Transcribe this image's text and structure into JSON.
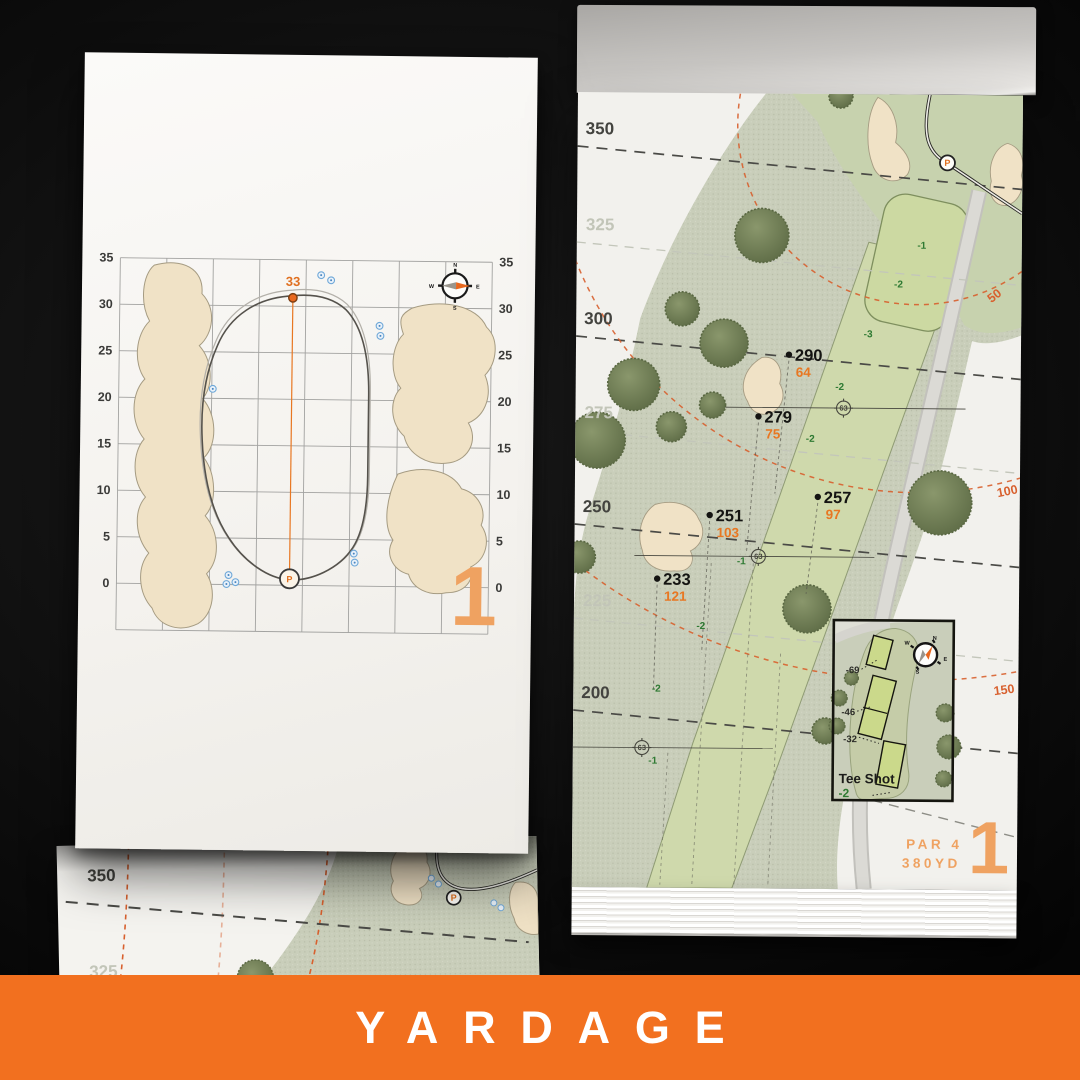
{
  "banner": {
    "label": "YARDAGE",
    "background": "#F2701F",
    "text_color": "#FFFFFF"
  },
  "colors": {
    "accent_orange": "#E87722",
    "page_number_orange": "#EFA261",
    "arc_orange": "#D8602E",
    "paper": "#F3F2EE",
    "rough_green": "#C9CEBA",
    "fairway_green": "#CFD9AC",
    "bunker_sand": "#F0E2C6",
    "tree_green": "#76845C",
    "elevation_green": "#2F7A33",
    "sprinkler_blue": "#6FA8D8"
  },
  "left_page": {
    "hole_number": "1",
    "front_distance": "33",
    "pin_symbol": "P",
    "axis_ticks": [
      "35",
      "30",
      "25",
      "20",
      "15",
      "10",
      "5",
      "0"
    ],
    "compass": {
      "n": "N",
      "e": "E",
      "s": "S",
      "w": "W"
    }
  },
  "right_page": {
    "hole_number": "1",
    "par": "PAR 4",
    "distance": "380YD",
    "pin_symbol": "P",
    "yardage_labels": [
      {
        "text": "350",
        "emphasis": "bold"
      },
      {
        "text": "325",
        "emphasis": "faint"
      },
      {
        "text": "300",
        "emphasis": "bold"
      },
      {
        "text": "275",
        "emphasis": "faint"
      },
      {
        "text": "250",
        "emphasis": "bold"
      },
      {
        "text": "225",
        "emphasis": "faint"
      },
      {
        "text": "200",
        "emphasis": "bold"
      }
    ],
    "arc_labels": [
      "50",
      "100",
      "150"
    ],
    "points": [
      {
        "carry": "290",
        "front": "64"
      },
      {
        "carry": "279",
        "front": "75"
      },
      {
        "carry": "257",
        "front": "97"
      },
      {
        "carry": "251",
        "front": "103"
      },
      {
        "carry": "233",
        "front": "121"
      }
    ],
    "sprinkler_numbers": [
      "63",
      "63",
      "63"
    ],
    "elevation_labels": [
      "-1",
      "-2",
      "-3",
      "-2",
      "-2",
      "-1",
      "-2",
      "-2",
      "-1"
    ],
    "tee_inset": {
      "title": "Tee Shot",
      "elevation": "-2",
      "tee_distances": [
        "-69",
        "-46",
        "-32"
      ],
      "compass": {
        "n": "N",
        "e": "E",
        "s": "S",
        "w": "W"
      }
    }
  },
  "back_page": {
    "pin_symbol": "P",
    "yardage_labels": [
      {
        "text": "350",
        "emphasis": "bold"
      },
      {
        "text": "325",
        "emphasis": "faint"
      }
    ]
  }
}
